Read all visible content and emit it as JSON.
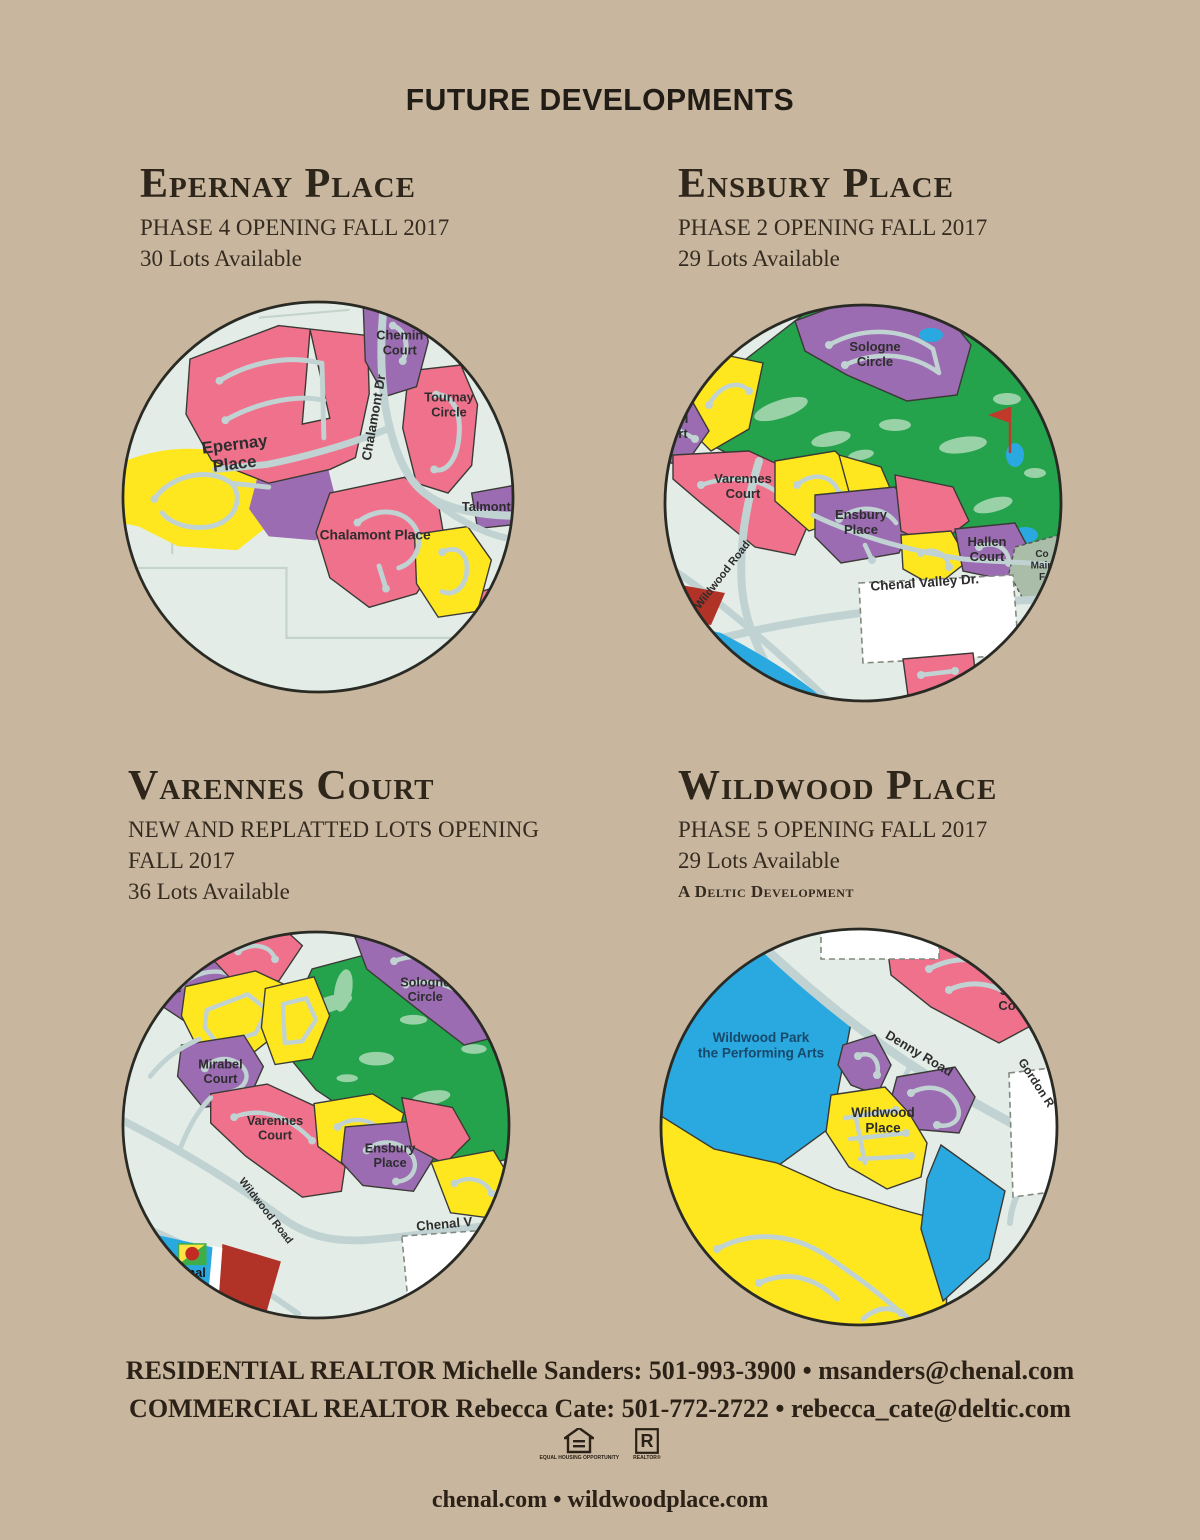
{
  "page": {
    "title": "FUTURE DEVELOPMENTS"
  },
  "palette": {
    "page_bg": "#c8b79e",
    "ink": "#211c15",
    "map_mint": "#e3ece6",
    "map_pink": "#f0718c",
    "map_purple": "#9c6cb2",
    "map_yellow": "#ffe71f",
    "map_green": "#24a24c",
    "map_green_light": "#9ad2a8",
    "map_blue": "#2aa9e1",
    "map_dark_red": "#b13226",
    "map_road": "#c0d3d2",
    "park_label_navy": "#17496b"
  },
  "sections": [
    {
      "id": "epernay",
      "title": "Epernay Place",
      "line1": "PHASE 4 OPENING FALL 2017",
      "line2": "30 Lots Available"
    },
    {
      "id": "ensbury",
      "title": "Ensbury Place",
      "line1": "PHASE 2 OPENING FALL 2017",
      "line2": "29 Lots Available"
    },
    {
      "id": "varennes",
      "title": "Varennes Court",
      "line1": "NEW AND REPLATTED LOTS OPENING FALL 2017",
      "line2": "36 Lots Available"
    },
    {
      "id": "wildwood",
      "title": "Wildwood Place",
      "line1": "PHASE 5 OPENING FALL 2017",
      "line2": "29 Lots Available",
      "line3": "A Deltic Development"
    }
  ],
  "maps": {
    "epernay": {
      "labels": [
        {
          "t": [
            "Chemin",
            "Court"
          ],
          "x": 283,
          "y": 40,
          "s": 13
        },
        {
          "t": "Chalamont Dr",
          "x": 261,
          "y": 120,
          "s": 13.5,
          "r": -80
        },
        {
          "t": [
            "Tournay",
            "Circle"
          ],
          "x": 333,
          "y": 103,
          "s": 13
        },
        {
          "t": [
            "Epernay",
            "Place"
          ],
          "x": 116,
          "y": 152,
          "s": 17,
          "r": -7
        },
        {
          "t": "Chalamont Place",
          "x": 258,
          "y": 243,
          "s": 14
        },
        {
          "t": "Talmont P",
          "x": 377,
          "y": 214,
          "s": 13
        }
      ]
    },
    "ensbury": {
      "labels": [
        {
          "t": [
            "Sologne",
            "Circle"
          ],
          "x": 212,
          "y": 48,
          "s": 13
        },
        {
          "t": [
            "bel",
            "urt"
          ],
          "x": 16,
          "y": 120,
          "s": 13
        },
        {
          "t": [
            "Varennes",
            "Court"
          ],
          "x": 80,
          "y": 180,
          "s": 13
        },
        {
          "t": [
            "Ensbury",
            "Place"
          ],
          "x": 198,
          "y": 216,
          "s": 13
        },
        {
          "t": [
            "Hallen",
            "Court"
          ],
          "x": 324,
          "y": 243,
          "s": 13
        },
        {
          "t": "Wildwood Road",
          "x": 62,
          "y": 274,
          "s": 11,
          "r": -52
        },
        {
          "t": "Chenal Valley Dr.",
          "x": 262,
          "y": 284,
          "s": 13.5,
          "r": -4
        },
        {
          "t": [
            "Co",
            "Main",
            "F"
          ],
          "x": 379,
          "y": 254,
          "s": 10
        }
      ]
    },
    "varennes": {
      "labels": [
        {
          "t": "ce",
          "x": 55,
          "y": 64,
          "s": 13
        },
        {
          "t": [
            "Sologne",
            "Circle"
          ],
          "x": 312,
          "y": 58,
          "s": 13
        },
        {
          "t": [
            "Mirabel",
            "Court"
          ],
          "x": 102,
          "y": 142,
          "s": 13
        },
        {
          "t": [
            "Varennes",
            "Court"
          ],
          "x": 158,
          "y": 200,
          "s": 13
        },
        {
          "t": [
            "Ensbury",
            "Place"
          ],
          "x": 276,
          "y": 228,
          "s": 13
        },
        {
          "t": "Wildwood Road",
          "x": 146,
          "y": 290,
          "s": 11,
          "r": 52
        },
        {
          "t": "Chenal V",
          "x": 332,
          "y": 306,
          "s": 13.5,
          "r": -5
        },
        {
          "t": [
            "henal",
            "ntary"
          ],
          "x": 70,
          "y": 356,
          "s": 13,
          "c": "#141414"
        }
      ]
    },
    "wildwood": {
      "labels": [
        {
          "t": [
            "Wildwood Park",
            "the Performing Arts"
          ],
          "x": 102,
          "y": 115,
          "s": 13.5,
          "c": "#17496b"
        },
        {
          "t": "Denny Road",
          "x": 258,
          "y": 130,
          "s": 13,
          "r": 31
        },
        {
          "t": [
            "Sez",
            "Cou"
          ],
          "x": 352,
          "y": 68,
          "s": 13
        },
        {
          "t": [
            "Wildwood",
            "Place"
          ],
          "x": 224,
          "y": 190,
          "s": 13.5
        },
        {
          "t": "Gordon R",
          "x": 374,
          "y": 158,
          "s": 12,
          "r": 57
        }
      ]
    }
  },
  "footer": {
    "residential": "RESIDENTIAL REALTOR Michelle Sanders: 501-993-3900 • msanders@chenal.com",
    "commercial": "COMMERCIAL REALTOR Rebecca Cate: 501-772-2722 • rebecca_cate@deltic.com",
    "websites": "chenal.com • wildwoodplace.com",
    "eho_caption": "EQUAL HOUSING OPPORTUNITY",
    "realtor_caption": "REALTOR®",
    "realtor_r": "R"
  }
}
